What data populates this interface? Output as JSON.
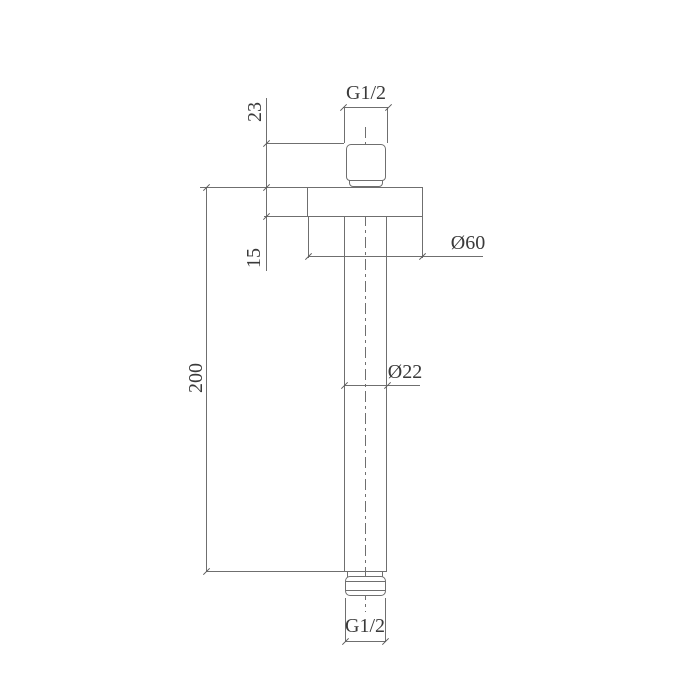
{
  "drawing": {
    "labels": {
      "thread_top": "G1/2",
      "dim_thread_height": "23",
      "dim_flange_thickness": "15",
      "dim_arm_length": "200",
      "dim_flange_diameter": "Ø60",
      "dim_pipe_diameter": "Ø22",
      "thread_bottom": "G1/2"
    },
    "colors": {
      "background": "#ffffff",
      "line": "#6f6f6f",
      "text": "#3a3a3a"
    }
  }
}
